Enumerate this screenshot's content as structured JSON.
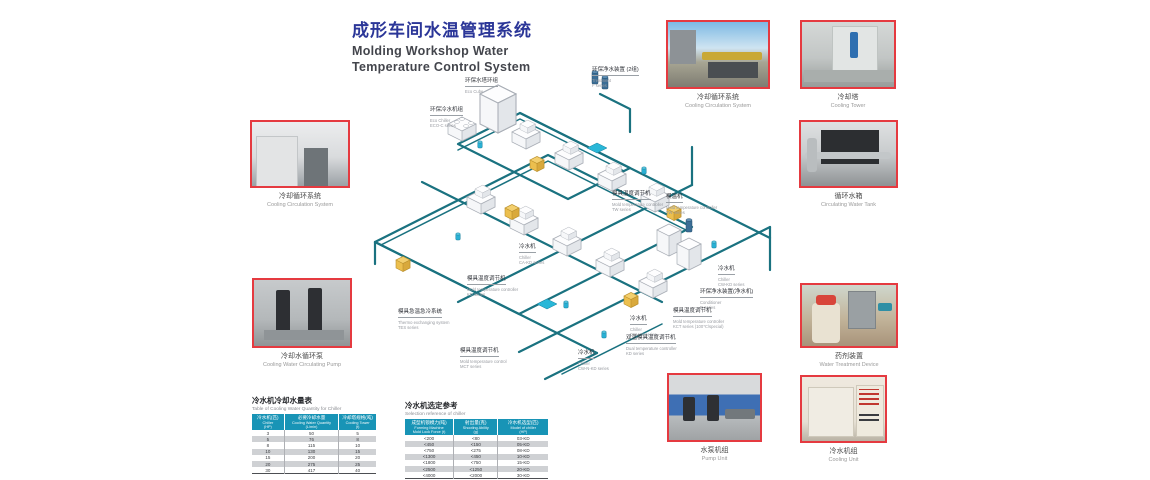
{
  "title": {
    "zh": "成形车间水温管理系统",
    "en_line1": "Molding Workshop Water",
    "en_line2": "Temperature Control System"
  },
  "colors": {
    "title_blue": "#2b3698",
    "photo_border_red": "#e53a40",
    "pipe_teal": "#1a7280",
    "table_header_teal": "#1894b6",
    "controller_yellow": "#ecbf4e",
    "pump_cyan": "#2ab0d4"
  },
  "photos": [
    {
      "zh": "冷却循环系统",
      "en": "Cooling Circulation System"
    },
    {
      "zh": "冷却水循环泵",
      "en": "Cooling Water Circulating Pump"
    },
    {
      "zh": "冷却循环系统",
      "en": "Cooling Circulation System"
    },
    {
      "zh": "冷却塔",
      "en": "Cooling Tower"
    },
    {
      "zh": "循环水箱",
      "en": "Circulating Water Tank"
    },
    {
      "zh": "药剂装置",
      "en": "Water Treatment Device"
    },
    {
      "zh": "水泵机组",
      "en": "Pump Unit"
    },
    {
      "zh": "冷水机组",
      "en": "Cooling Unit"
    }
  ],
  "diagram": {
    "labels": [
      {
        "zh": "环保水塔环组",
        "en1": "Eco Cube",
        "en2": ""
      },
      {
        "zh": "环保净水装置 (2组)",
        "en1": "Treatment",
        "en2": "F series"
      },
      {
        "zh": "环保冷水机组",
        "en1": "Eco Chiller",
        "en2": "ECO-C series"
      },
      {
        "zh": "模具温度调节机",
        "en1": "Mold temperature controller",
        "en2": "TW series"
      },
      {
        "zh": "模温机",
        "en1": "Mold temperature controller",
        "en2": "TW series"
      },
      {
        "zh": "冷水机",
        "en1": "Chiller",
        "en2": "CA-KD series"
      },
      {
        "zh": "模具温度调节机",
        "en1": "Mold temperature controller",
        "en2": "KD series"
      },
      {
        "zh": "模具急温急冷系统",
        "en1": "Thermo exchanging system",
        "en2": "TES series"
      },
      {
        "zh": "模具温度调节机",
        "en1": "Mold temperature control",
        "en2": "MCT series"
      },
      {
        "zh": "冷水机",
        "en1": "Chiller",
        "en2": "CW-N-KD series"
      },
      {
        "zh": "冷水机",
        "en1": "Chiller",
        "en2": "CW-KD series"
      },
      {
        "zh": "双温模具温度调节机",
        "en1": "Dual temperature controller",
        "en2": "KD series"
      },
      {
        "zh": "冷水机",
        "en1": "Chiller",
        "en2": "CW-KD series"
      },
      {
        "zh": "环保净水装置(净水机)",
        "en1": "Conditioner",
        "en2": "D series"
      },
      {
        "zh": "模具温度调节机",
        "en1": "Mold temperature controller",
        "en2": "KCT series (100℃/special)"
      }
    ]
  },
  "tables": {
    "left": {
      "title_zh": "冷水机冷却水量表",
      "title_en": "Table of Cooling Water Quantity for Chiller",
      "headers": [
        {
          "zh": "冷水机(匹)",
          "en": "Chiller",
          "unit": "(HP)"
        },
        {
          "zh": "必要冷却水量",
          "en": "Cooling Water Quantity",
          "unit": "(L/min)"
        },
        {
          "zh": "冷却塔规格(吨)",
          "en": "Cooling Tower",
          "unit": "(t)"
        }
      ],
      "rows": [
        [
          "3",
          "50",
          "5"
        ],
        [
          "5",
          "76",
          "8"
        ],
        [
          "8",
          "115",
          "10"
        ],
        [
          "10",
          "130",
          "15"
        ],
        [
          "15",
          "200",
          "20"
        ],
        [
          "20",
          "275",
          "25"
        ],
        [
          "30",
          "417",
          "40"
        ]
      ]
    },
    "right": {
      "title_zh": "冷水机选定参考",
      "title_en": "Selection reference of chiller",
      "headers": [
        {
          "zh": "成型机锁模力(吨)",
          "en": "Forming Machine",
          "unit": "Mold Lock Force (t)"
        },
        {
          "zh": "射出量(克)",
          "en": "Shooting Ability",
          "unit": "(g)"
        },
        {
          "zh": "冷水机选型(匹)",
          "en": "Model of chiller",
          "unit": "(HP)"
        }
      ],
      "rows": [
        [
          "<200",
          "<80",
          "03-KD"
        ],
        [
          "<450",
          "<150",
          "05-KD"
        ],
        [
          "<750",
          "<275",
          "08-KD"
        ],
        [
          "<1300",
          "<450",
          "10-KD"
        ],
        [
          "<1800",
          "<750",
          "15-KD"
        ],
        [
          "<2500",
          "<1250",
          "20-KD"
        ],
        [
          "<4000",
          "<2000",
          "30-KD"
        ]
      ]
    }
  }
}
